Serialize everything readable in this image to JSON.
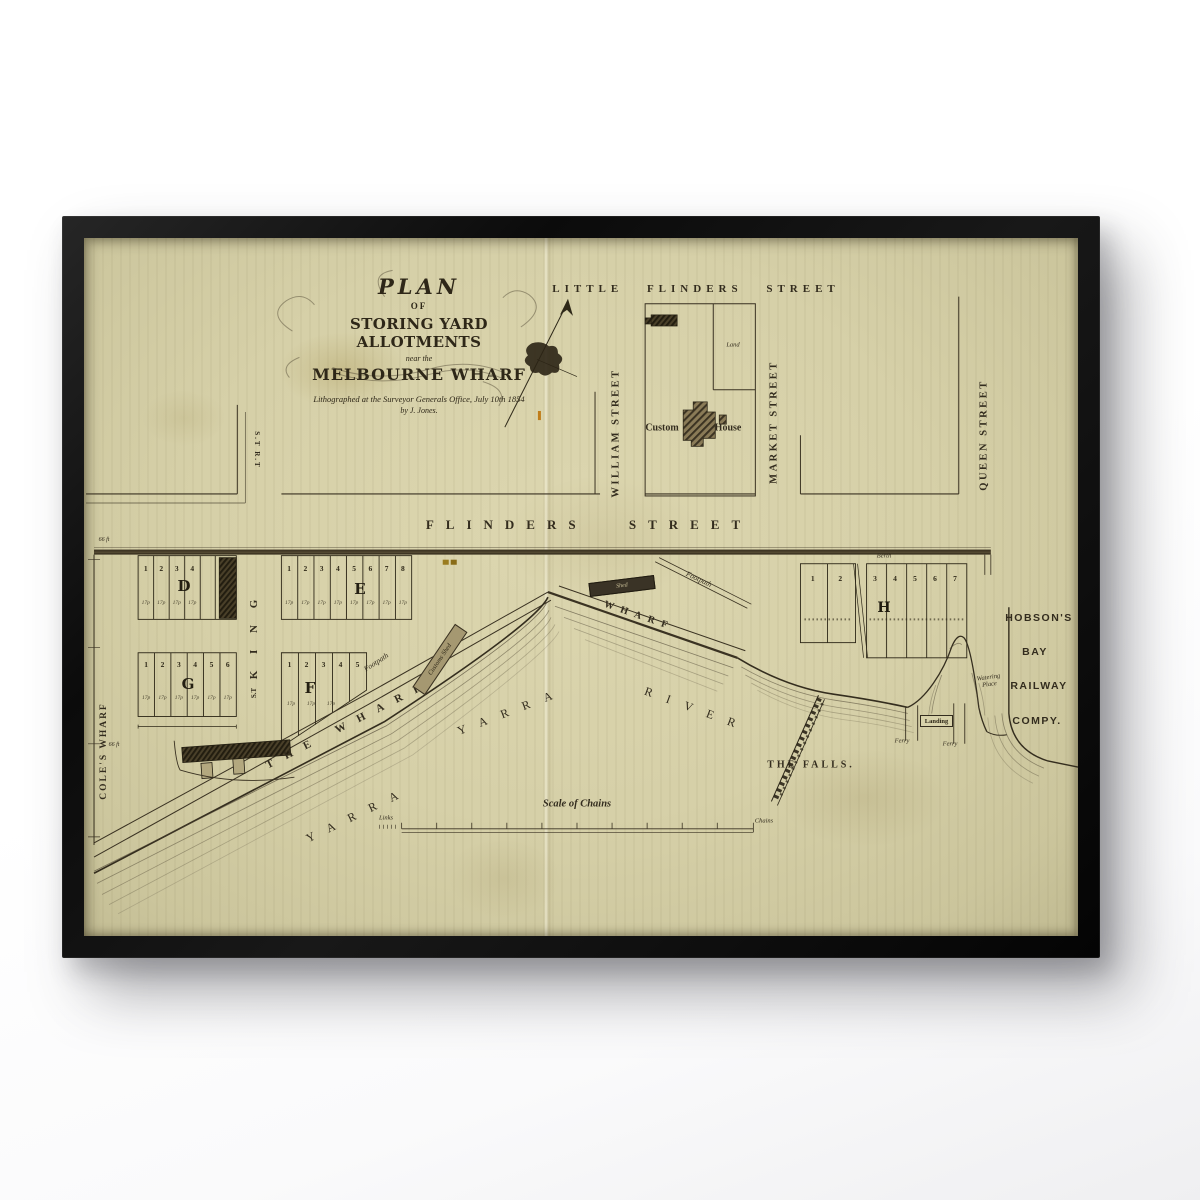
{
  "product": {
    "background": "#ffffff",
    "frame_color": "#101010",
    "paper_color": "#d6d0a9",
    "ink_color": "#332c1e",
    "accent_orange": "#c07d1a"
  },
  "map": {
    "title": {
      "plan": "PLAN",
      "of": "OF",
      "storing": "STORING YARD ALLOTMENTS",
      "near_the": "near the",
      "melbourne": "MELBOURNE WHARF",
      "credit_line1": "Lithographed at the Surveyor Generals Office, July 10th 1854",
      "credit_line2": "by J. Jones."
    },
    "streets": {
      "little_flinders": "LITTLE FLINDERS STREET",
      "flinders": "FLINDERS STREET",
      "william": "WILLIAM STREET",
      "market": "MARKET STREET",
      "queen": "QUEEN STREET",
      "king": "K I N G",
      "king_st": "S.T",
      "spencer": "S.T R.T",
      "coles_wharf": "COLE'S WHARF"
    },
    "labels": {
      "custom": "Custom",
      "house": "House",
      "land": "Land",
      "berth": "Berth",
      "footpath": "Footpath",
      "wharf": "WHARF",
      "the_wharf": "THE WHARF",
      "yarra": "YARRA",
      "river": "RIVER",
      "the_falls": "THE FALLS.",
      "ferry": "Ferry",
      "landing": "Landing",
      "watering": "Watering",
      "place": "Place",
      "shed": "Shed",
      "customs_shed": "Customs Shed",
      "hobsons": "HOBSON'S",
      "bay": "BAY",
      "railway": "RAILWAY",
      "compy": "COMPY.",
      "scale_title": "Scale of Chains",
      "links": "Links",
      "chains": "Chains",
      "dim_66ft": "66 ft",
      "lot_size": "17p"
    },
    "blocks": {
      "d": {
        "letter": "D",
        "lots": [
          "1",
          "2",
          "3",
          "4"
        ]
      },
      "e": {
        "letter": "E",
        "lots": [
          "1",
          "2",
          "3",
          "4",
          "5",
          "6",
          "7",
          "8"
        ]
      },
      "g": {
        "letter": "G",
        "lots": [
          "1",
          "2",
          "3",
          "4",
          "5",
          "6"
        ]
      },
      "f": {
        "letter": "F",
        "lots": [
          "1",
          "2",
          "3",
          "4",
          "5"
        ]
      },
      "h": {
        "letter": "H",
        "lots_west": [
          "1",
          "2"
        ],
        "lots_east": [
          "3",
          "4",
          "5",
          "6",
          "7"
        ]
      }
    }
  }
}
